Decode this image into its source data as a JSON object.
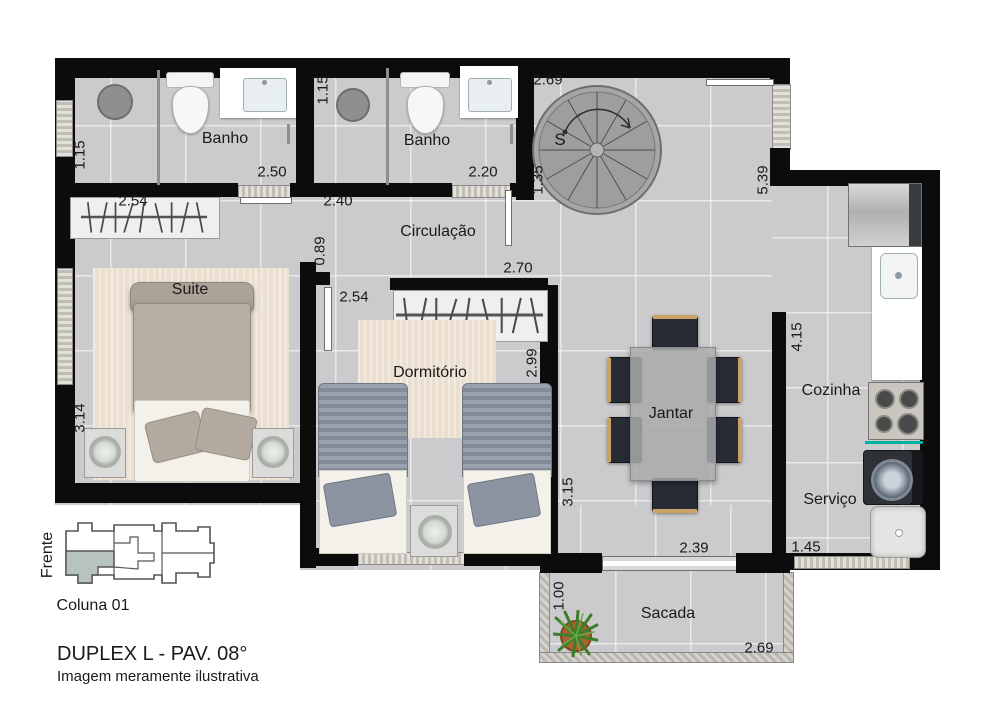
{
  "plan": {
    "rooms": {
      "banho1": "Banho",
      "banho2": "Banho",
      "circulacao": "Circulação",
      "suite": "Suite",
      "dormitorio": "Dormitório",
      "jantar": "Jantar",
      "cozinha": "Cozinha",
      "servico": "Serviço",
      "sacada": "Sacada"
    },
    "stairs": {
      "direction_label": "S"
    },
    "dimensions": {
      "banho1_depth": "1.15",
      "banho1_width": "2.50",
      "suite_closet_width": "2.54",
      "banho2_depth": "1.15",
      "banho2_width": "2.20",
      "circulacao_width": "2.40",
      "stairs_width": "2.69",
      "stairs_depth": "1.35",
      "living_depth": "5.39",
      "suite_door": "0.89",
      "dorm_closet_offset": "2.54",
      "dorm_closet_width": "2.70",
      "dorm_depth": "2.99",
      "suite_depth": "3.14",
      "jantar_depth": "3.15",
      "jantar_width": "2.39",
      "cozinha_depth": "4.15",
      "servico_width": "1.45",
      "sacada_depth": "1.00",
      "sacada_width": "2.69"
    }
  },
  "legend": {
    "front": "Frente",
    "column": "Coluna 01",
    "title": "DUPLEX L - PAV. 08°",
    "disclaimer": "Imagem meramente ilustrativa"
  },
  "colors": {
    "wall": "#0c0c0c",
    "floor_tile": "#cbcbcd",
    "rug": "#ebdfcf",
    "accent_teal": "#00b2a0",
    "keyplan_highlight": "#b7c3c0"
  }
}
